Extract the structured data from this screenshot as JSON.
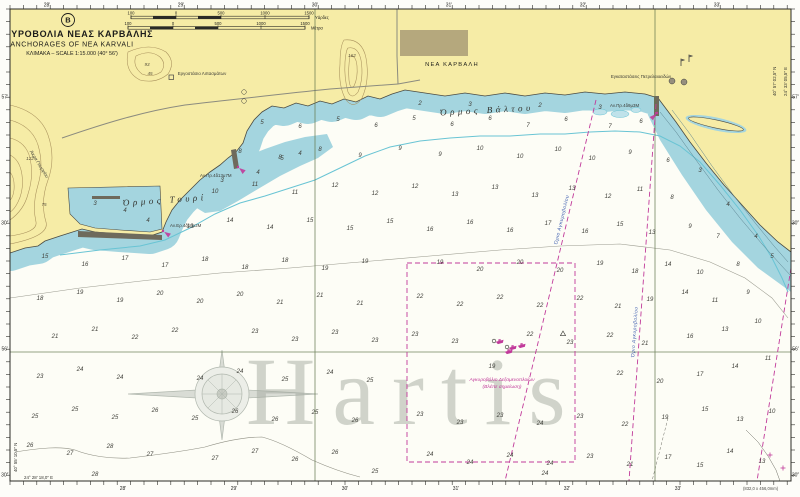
{
  "title_block": {
    "badge": "B",
    "title_gr": "ΑΓΚΥΡΟΒΟΛΙΑ ΝΕΑΣ ΚΑΡΒΑΛΗΣ",
    "title_en": "ANCHORAGES OF NEA KARVALI",
    "scale_note": "ΚΛΙΜΑΚΑ – SCALE 1:15.000 (40° 56')"
  },
  "scale_bars": {
    "yards_unit": "Υάρδες",
    "meters_unit": "Μέτρα",
    "yards_ticks": [
      [
        131,
        "100"
      ],
      [
        176,
        "0"
      ],
      [
        221,
        "500"
      ],
      [
        265,
        "1000"
      ],
      [
        309,
        "1500"
      ]
    ],
    "meters_ticks": [
      [
        128,
        "100"
      ],
      [
        173,
        "0"
      ],
      [
        218,
        "500"
      ],
      [
        261,
        "1000"
      ],
      [
        305,
        "1500"
      ]
    ]
  },
  "places": {
    "village": "ΝΕΑ ΚΑΡΒΑΛΗ",
    "bay_west": "Όρμος Τουρί",
    "bay_east": "Όρμος Βάλτου",
    "cape": "Άκρα Γεωργίου",
    "factory": "Εργοστάσιο Λιπασμάτων",
    "oil_terminal": "Εγκαταστάσεις Πετρελαιοειδών"
  },
  "anchorage": {
    "note_line1": "Αγκυροβόλιο Δεξαμενοπλοίων",
    "note_line2": "(Βλέπε σημείωση)",
    "limit_label": "Όριο Αγκυροβολίου"
  },
  "lights": [
    {
      "x": 163,
      "y": 231,
      "angle": 35,
      "label": "Αν.Ερ.4δ10μ2Μ",
      "lx": 170,
      "ly": 227
    },
    {
      "x": 238,
      "y": 167,
      "angle": 40,
      "label": "Αν.Πρ.4δ13μ7Μ",
      "lx": 200,
      "ly": 177
    },
    {
      "x": 657,
      "y": 113,
      "angle": 135,
      "label": "Αν.Πρ.4δ9μ3Μ",
      "lx": 610,
      "ly": 107
    }
  ],
  "border": {
    "top": [
      [
        47,
        "28'"
      ],
      [
        181,
        "29'"
      ],
      [
        315,
        "30'"
      ],
      [
        449,
        "31'"
      ],
      [
        583,
        "32'"
      ],
      [
        717,
        "33'"
      ]
    ],
    "bottom": [
      [
        123,
        "28'"
      ],
      [
        234,
        "29'"
      ],
      [
        345,
        "30'"
      ],
      [
        456,
        "31'"
      ],
      [
        567,
        "32'"
      ],
      [
        678,
        "33'"
      ]
    ],
    "left": [
      [
        97,
        "57'"
      ],
      [
        223,
        "30″"
      ],
      [
        349,
        "56'"
      ],
      [
        475,
        "30″"
      ]
    ],
    "right": [
      [
        97,
        "57'"
      ],
      [
        223,
        "30″"
      ],
      [
        349,
        "56'"
      ],
      [
        475,
        "30″"
      ]
    ],
    "corner_top_right_lat": "40° 57′ 02,5″ N",
    "corner_top_right_lon": "24° 33′ 05,5″ E",
    "corner_bottom_left_lat": "40° 55′ 10,5″ N",
    "corner_bottom_left_lon": "24° 28′ 18,0″ E"
  },
  "notes": {
    "dimensions": "(832,0 x 456,0mm)"
  },
  "watermark": {
    "text": "Hartis"
  },
  "colors": {
    "land": "#f6eca6",
    "village_block": "#b5a87d",
    "shallow": "#a4d5df",
    "shoal_fill": "#bfe2ea",
    "cyan_contour": "#69c4d4",
    "magenta": "#c13a9a",
    "limit_blue": "#3b5bae",
    "graticule": "#64784f"
  },
  "spot_heights": [
    [
      352,
      57,
      "162"
    ],
    [
      147,
      66,
      "93"
    ],
    [
      150,
      75,
      "45"
    ],
    [
      30,
      160,
      "122"
    ],
    [
      44,
      206,
      "75"
    ]
  ],
  "soundings": [
    [
      95,
      205,
      "3"
    ],
    [
      125,
      212,
      "4"
    ],
    [
      148,
      222,
      "4"
    ],
    [
      222,
      182,
      "3"
    ],
    [
      258,
      174,
      "4"
    ],
    [
      300,
      155,
      "4"
    ],
    [
      282,
      160,
      "5"
    ],
    [
      420,
      105,
      "2"
    ],
    [
      470,
      106,
      "3"
    ],
    [
      540,
      107,
      "2"
    ],
    [
      600,
      109,
      "3"
    ],
    [
      700,
      172,
      "3"
    ],
    [
      728,
      206,
      "4"
    ],
    [
      756,
      238,
      "4"
    ],
    [
      772,
      258,
      "5"
    ],
    [
      262,
      124,
      "5"
    ],
    [
      300,
      128,
      "6"
    ],
    [
      338,
      121,
      "5"
    ],
    [
      376,
      127,
      "6"
    ],
    [
      414,
      120,
      "5"
    ],
    [
      452,
      126,
      "6"
    ],
    [
      490,
      120,
      "6"
    ],
    [
      528,
      127,
      "7"
    ],
    [
      566,
      121,
      "6"
    ],
    [
      610,
      128,
      "7"
    ],
    [
      641,
      123,
      "6"
    ],
    [
      240,
      153,
      "8"
    ],
    [
      280,
      159,
      "8"
    ],
    [
      320,
      151,
      "8"
    ],
    [
      360,
      157,
      "9"
    ],
    [
      400,
      150,
      "9"
    ],
    [
      440,
      156,
      "9"
    ],
    [
      480,
      150,
      "10"
    ],
    [
      520,
      158,
      "10"
    ],
    [
      558,
      151,
      "10"
    ],
    [
      592,
      160,
      "10"
    ],
    [
      630,
      154,
      "9"
    ],
    [
      668,
      162,
      "6"
    ],
    [
      215,
      193,
      "10"
    ],
    [
      255,
      186,
      "11"
    ],
    [
      295,
      194,
      "11"
    ],
    [
      335,
      187,
      "12"
    ],
    [
      375,
      195,
      "12"
    ],
    [
      415,
      188,
      "12"
    ],
    [
      455,
      196,
      "13"
    ],
    [
      495,
      189,
      "13"
    ],
    [
      535,
      197,
      "13"
    ],
    [
      572,
      190,
      "13"
    ],
    [
      608,
      198,
      "12"
    ],
    [
      640,
      191,
      "11"
    ],
    [
      672,
      199,
      "8"
    ],
    [
      190,
      228,
      "13"
    ],
    [
      230,
      222,
      "14"
    ],
    [
      270,
      229,
      "14"
    ],
    [
      310,
      222,
      "15"
    ],
    [
      350,
      230,
      "15"
    ],
    [
      390,
      223,
      "15"
    ],
    [
      430,
      231,
      "16"
    ],
    [
      470,
      224,
      "16"
    ],
    [
      510,
      232,
      "16"
    ],
    [
      548,
      225,
      "17"
    ],
    [
      585,
      233,
      "16"
    ],
    [
      620,
      226,
      "15"
    ],
    [
      652,
      234,
      "13"
    ],
    [
      690,
      228,
      "9"
    ],
    [
      718,
      238,
      "7"
    ],
    [
      45,
      258,
      "15"
    ],
    [
      85,
      266,
      "16"
    ],
    [
      125,
      260,
      "17"
    ],
    [
      165,
      267,
      "17"
    ],
    [
      205,
      261,
      "18"
    ],
    [
      245,
      269,
      "18"
    ],
    [
      285,
      262,
      "18"
    ],
    [
      325,
      270,
      "19"
    ],
    [
      365,
      263,
      "19"
    ],
    [
      440,
      264,
      "19"
    ],
    [
      480,
      271,
      "20"
    ],
    [
      520,
      264,
      "20"
    ],
    [
      560,
      272,
      "20"
    ],
    [
      600,
      265,
      "19"
    ],
    [
      635,
      273,
      "18"
    ],
    [
      668,
      266,
      "14"
    ],
    [
      700,
      274,
      "10"
    ],
    [
      738,
      266,
      "8"
    ],
    [
      40,
      300,
      "18"
    ],
    [
      80,
      294,
      "19"
    ],
    [
      120,
      302,
      "19"
    ],
    [
      160,
      295,
      "20"
    ],
    [
      200,
      303,
      "20"
    ],
    [
      240,
      296,
      "20"
    ],
    [
      280,
      304,
      "21"
    ],
    [
      320,
      297,
      "21"
    ],
    [
      360,
      305,
      "21"
    ],
    [
      420,
      298,
      "22"
    ],
    [
      460,
      306,
      "22"
    ],
    [
      500,
      299,
      "22"
    ],
    [
      540,
      307,
      "22"
    ],
    [
      580,
      300,
      "22"
    ],
    [
      618,
      308,
      "21"
    ],
    [
      650,
      301,
      "19"
    ],
    [
      685,
      294,
      "14"
    ],
    [
      715,
      302,
      "11"
    ],
    [
      748,
      294,
      "9"
    ],
    [
      55,
      338,
      "21"
    ],
    [
      95,
      331,
      "21"
    ],
    [
      135,
      339,
      "22"
    ],
    [
      175,
      332,
      "22"
    ],
    [
      255,
      333,
      "23"
    ],
    [
      295,
      341,
      "23"
    ],
    [
      335,
      334,
      "23"
    ],
    [
      375,
      342,
      "23"
    ],
    [
      415,
      336,
      "23"
    ],
    [
      455,
      343,
      "23"
    ],
    [
      530,
      336,
      "22"
    ],
    [
      570,
      344,
      "23"
    ],
    [
      610,
      337,
      "22"
    ],
    [
      645,
      345,
      "21"
    ],
    [
      690,
      338,
      "16"
    ],
    [
      725,
      331,
      "13"
    ],
    [
      758,
      323,
      "10"
    ],
    [
      40,
      378,
      "23"
    ],
    [
      80,
      371,
      "24"
    ],
    [
      120,
      379,
      "24"
    ],
    [
      200,
      380,
      "24"
    ],
    [
      240,
      373,
      "24"
    ],
    [
      285,
      381,
      "25"
    ],
    [
      330,
      374,
      "24"
    ],
    [
      370,
      382,
      "25"
    ],
    [
      492,
      368,
      "19"
    ],
    [
      620,
      375,
      "22"
    ],
    [
      660,
      383,
      "20"
    ],
    [
      700,
      376,
      "17"
    ],
    [
      735,
      368,
      "14"
    ],
    [
      768,
      360,
      "11"
    ],
    [
      35,
      418,
      "25"
    ],
    [
      75,
      411,
      "25"
    ],
    [
      115,
      419,
      "25"
    ],
    [
      155,
      412,
      "26"
    ],
    [
      195,
      420,
      "25"
    ],
    [
      235,
      413,
      "26"
    ],
    [
      275,
      421,
      "26"
    ],
    [
      315,
      414,
      "25"
    ],
    [
      355,
      422,
      "26"
    ],
    [
      420,
      416,
      "23"
    ],
    [
      460,
      424,
      "23"
    ],
    [
      500,
      417,
      "23"
    ],
    [
      540,
      425,
      "24"
    ],
    [
      580,
      418,
      "23"
    ],
    [
      625,
      426,
      "22"
    ],
    [
      665,
      419,
      "19"
    ],
    [
      705,
      411,
      "15"
    ],
    [
      740,
      421,
      "13"
    ],
    [
      772,
      413,
      "10"
    ],
    [
      30,
      447,
      "26"
    ],
    [
      70,
      455,
      "27"
    ],
    [
      110,
      448,
      "28"
    ],
    [
      150,
      456,
      "27"
    ],
    [
      215,
      460,
      "27"
    ],
    [
      255,
      453,
      "27"
    ],
    [
      295,
      461,
      "26"
    ],
    [
      335,
      454,
      "26"
    ],
    [
      430,
      456,
      "24"
    ],
    [
      470,
      464,
      "24"
    ],
    [
      510,
      457,
      "24"
    ],
    [
      550,
      465,
      "24"
    ],
    [
      590,
      458,
      "23"
    ],
    [
      630,
      466,
      "21"
    ],
    [
      668,
      459,
      "17"
    ],
    [
      700,
      467,
      "15"
    ],
    [
      730,
      453,
      "14"
    ],
    [
      762,
      463,
      "13"
    ],
    [
      95,
      476,
      "28"
    ],
    [
      375,
      473,
      "25"
    ],
    [
      545,
      475,
      "24"
    ]
  ],
  "symbols": {
    "ships": [
      [
        500,
        342
      ],
      [
        513,
        348
      ],
      [
        509,
        352
      ],
      [
        522,
        346
      ]
    ],
    "circles": [
      [
        494,
        341
      ],
      [
        507,
        347
      ]
    ],
    "triangles": [
      [
        563,
        334
      ]
    ],
    "tanks": [
      [
        672,
        81
      ],
      [
        684,
        82
      ]
    ],
    "small_circles": [
      [
        244,
        92
      ],
      [
        244,
        101
      ]
    ],
    "crosses": [
      [
        770,
        455
      ],
      [
        783,
        468
      ]
    ]
  }
}
